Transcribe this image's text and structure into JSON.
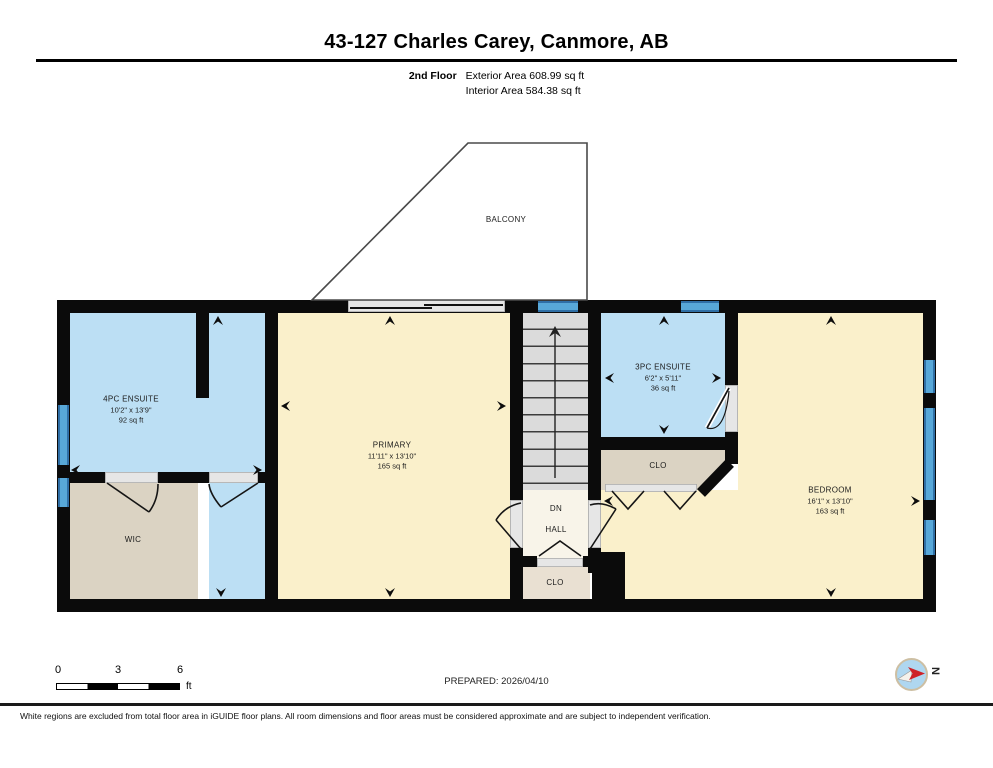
{
  "header": {
    "title": "43-127 Charles Carey, Canmore, AB",
    "floor": "2nd Floor",
    "exterior_area": "Exterior Area 608.99 sq ft",
    "interior_area": "Interior Area 584.38 sq ft"
  },
  "rooms": {
    "balcony": {
      "name": "BALCONY"
    },
    "ensuite4": {
      "name": "4PC ENSUITE",
      "dims": "10'2\" x 13'9\"",
      "area": "92 sq ft"
    },
    "wic": {
      "name": "WIC"
    },
    "primary": {
      "name": "PRIMARY",
      "dims": "11'11\" x 13'10\"",
      "area": "165 sq ft"
    },
    "ensuite3": {
      "name": "3PC ENSUITE",
      "dims": "6'2\" x 5'11\"",
      "area": "36 sq ft"
    },
    "closet_mid": {
      "name": "CLO"
    },
    "hall": {
      "name": "HALL",
      "stair_direction": "DN"
    },
    "closet_hall": {
      "name": "CLO"
    },
    "bedroom": {
      "name": "BEDROOM",
      "dims": "16'1\" x 13'10\"",
      "area": "163 sq ft"
    }
  },
  "scale_bar": {
    "ticks": [
      "0",
      "3",
      "6"
    ],
    "unit": "ft"
  },
  "prepared_label": "PREPARED: 2026/04/10",
  "compass": {
    "north_label": "N"
  },
  "footer_note": "White regions are excluded from total floor area in iGUIDE floor plans. All room dimensions and floor areas must be considered approximate and are subject to independent verification.",
  "colors": {
    "wall": "#0B0B0B",
    "room_wet_blue": "#BCDFF4",
    "room_cream": "#FAF0CB",
    "closet_tan": "#DBD3C3",
    "hall_offwhite": "#F8F4E9",
    "window_blue": "#58A8D8",
    "compass_red": "#CE2127"
  }
}
